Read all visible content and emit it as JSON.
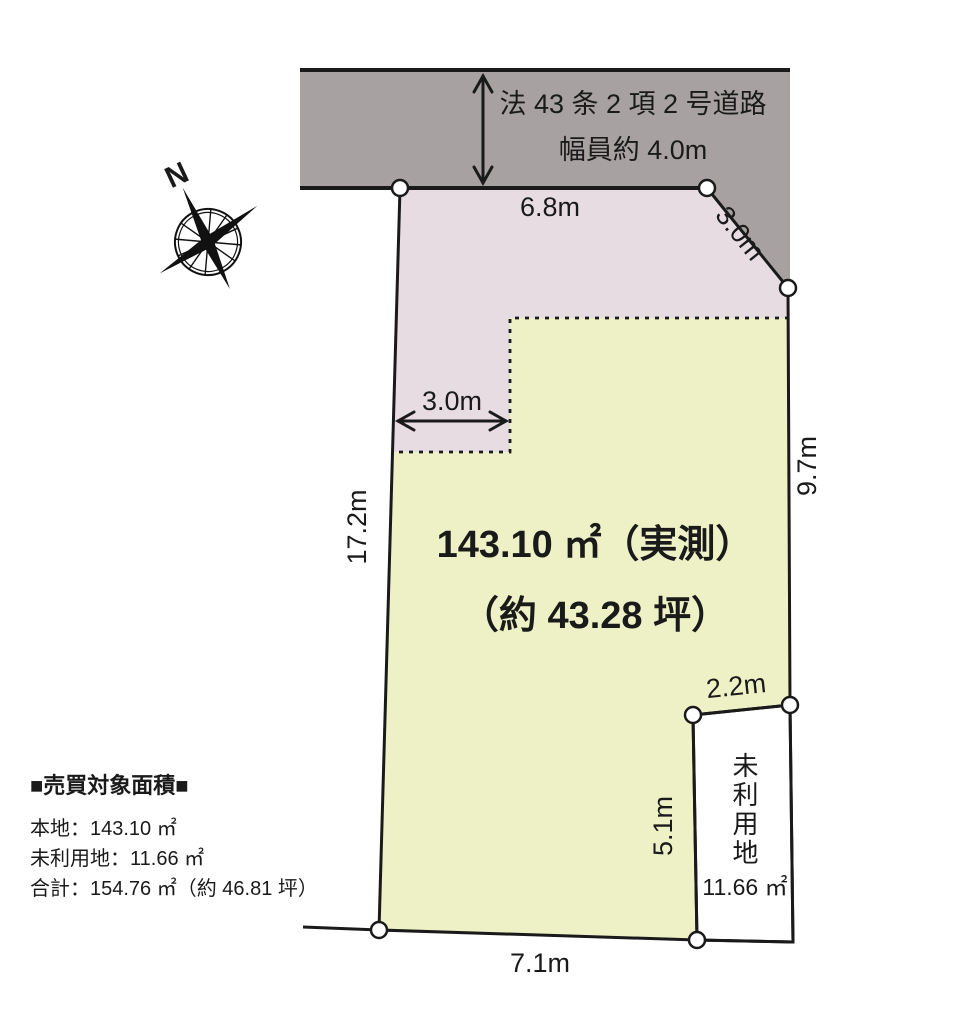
{
  "colors": {
    "road": "#a7a1a1",
    "setback": "#e8dce3",
    "plot": "#eef1c6",
    "unused": "#ffffff",
    "line": "#1a1a1a"
  },
  "road": {
    "name_line1": "法 43 条 2 項 2 号道路",
    "name_line2": "幅員約 4.0m"
  },
  "compass": {
    "north_label": "N"
  },
  "plot": {
    "area_line1": "143.10 ㎡（実測）",
    "area_line2": "（約 43.28 坪）"
  },
  "unused_lot": {
    "label": "未利用地",
    "area": "11.66 ㎡"
  },
  "dimensions": {
    "road_frontage": "6.8m",
    "corner_cut": "3.0m",
    "setback_width": "3.0m",
    "left_side": "17.2m",
    "right_side": "9.7m",
    "unused_top": "2.2m",
    "unused_left": "5.1m",
    "bottom": "7.1m"
  },
  "legend": {
    "title": "■売買対象面積■",
    "lines": [
      "本地：143.10 ㎡",
      "未利用地：11.66 ㎡",
      "合計：154.76 ㎡（約 46.81 坪）"
    ]
  }
}
